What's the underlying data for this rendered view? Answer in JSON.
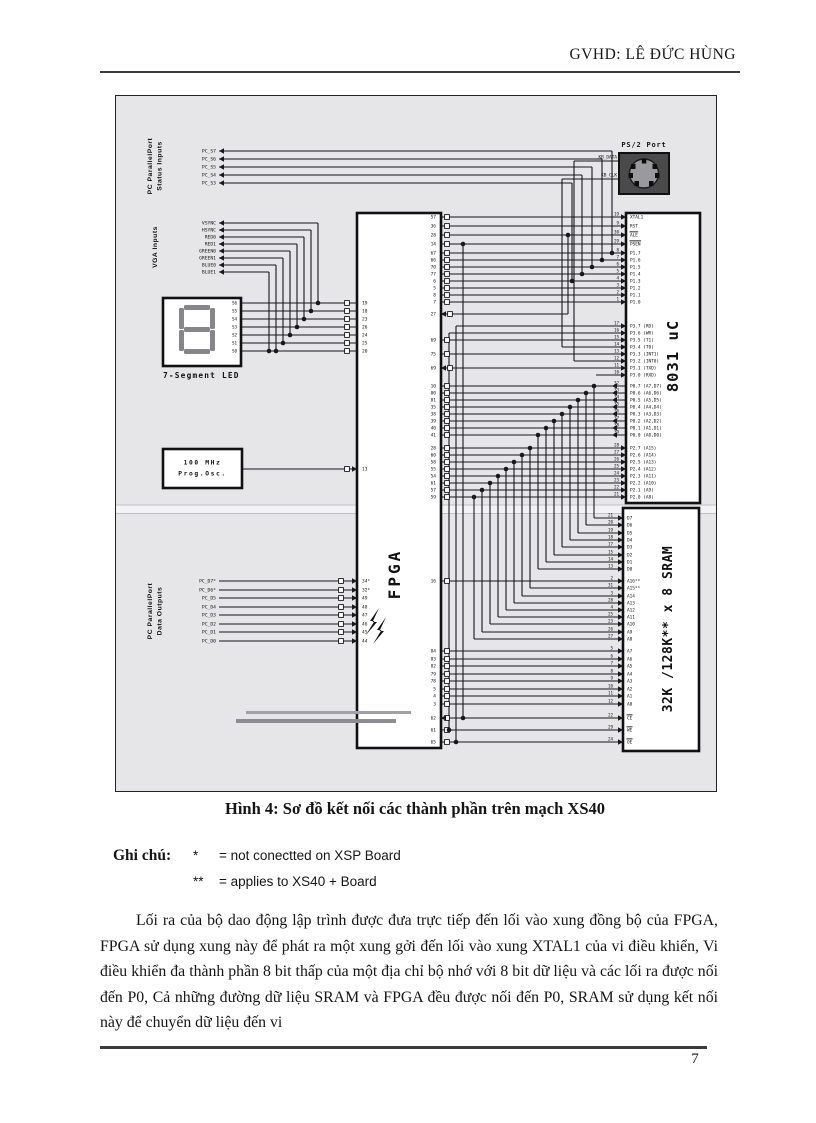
{
  "header": {
    "right": "GVHD: LÊ ĐỨC HÙNG"
  },
  "figure": {
    "caption": "Hình 4: Sơ đồ kết nối các thành phần trên mạch XS40",
    "pc_status": {
      "group_label_1": "PC ParallelPort",
      "group_label_2": "Status Inputs",
      "signals": [
        "PC_S7",
        "PC_S6",
        "PC_S5",
        "PC_S4",
        "PC_S3"
      ]
    },
    "vga": {
      "group_label": "VGA Inputs",
      "signals": [
        "VSYNC",
        "HSYNC",
        "RED0",
        "RED1",
        "GREEN0",
        "GREEN1",
        "BLUE0",
        "BLUE1"
      ]
    },
    "pc_data": {
      "group_label_1": "PC ParallelPort",
      "group_label_2": "Data Outputs",
      "signals": [
        "PC_D7*",
        "PC_D6*",
        "PC_D5",
        "PC_D4",
        "PC_D3",
        "PC_D2",
        "PC_D1",
        "PC_D0"
      ]
    },
    "seg_led": {
      "caption": "7-Segment LED",
      "pins": [
        "S6",
        "S5",
        "S4",
        "S3",
        "S2",
        "S1",
        "S0"
      ]
    },
    "osc": {
      "line1": "100 MHz",
      "line2": "Prog.Osc."
    },
    "ps2": {
      "title": "PS/2 Port",
      "signals": [
        "KB_DATA",
        "KB_CLK"
      ]
    },
    "fpga": {
      "label": "FPGA",
      "left_seg_pins": [
        "19",
        "18",
        "23",
        "26",
        "24",
        "25",
        "20"
      ],
      "osc_pin": "13",
      "left_data_pins": [
        "34*",
        "32*",
        "49",
        "48",
        "47",
        "46",
        "45",
        "44"
      ],
      "right_top_pins": [
        "57",
        "36",
        "28",
        "14",
        "67",
        "66",
        "70",
        "77",
        "6",
        "5",
        "8",
        "7"
      ],
      "right_single_pins": [
        "27",
        "69",
        "75",
        "69"
      ],
      "right_data_pins": [
        "10",
        "80",
        "81",
        "35",
        "38",
        "39",
        "40",
        "41"
      ],
      "a16_pin": "16",
      "right_addr_pins": [
        "28",
        "60",
        "58",
        "55",
        "54",
        "61",
        "57",
        "59"
      ],
      "right_addr_low_pins": [
        "84",
        "83",
        "82",
        "79",
        "78",
        "5",
        "4",
        "3"
      ],
      "right_ctrl_pins": [
        "62",
        "61",
        "65"
      ]
    },
    "mcu": {
      "label": "8031 uC",
      "top_pins": [
        {
          "num": "19",
          "name": "XTAL1"
        },
        {
          "num": "9",
          "name": "RST"
        },
        {
          "num": "30",
          "name": "ALE",
          "bar": true
        },
        {
          "num": "29",
          "name": "PSEN",
          "bar": true
        }
      ],
      "p1_pins": [
        {
          "num": "8",
          "name": "P1.7"
        },
        {
          "num": "7",
          "name": "P1.6"
        },
        {
          "num": "6",
          "name": "P1.5"
        },
        {
          "num": "5",
          "name": "P1.4"
        },
        {
          "num": "4",
          "name": "P1.3"
        },
        {
          "num": "3",
          "name": "P1.2"
        },
        {
          "num": "2",
          "name": "P1.1"
        },
        {
          "num": "1",
          "name": "P1.0"
        }
      ],
      "p3_pins": [
        {
          "num": "17",
          "name": "P3.7 (RD)"
        },
        {
          "num": "16",
          "name": "P3.6 (WR)"
        },
        {
          "num": "15",
          "name": "P3.5 (T1)"
        },
        {
          "num": "14",
          "name": "P3.4 (T0)"
        },
        {
          "num": "13",
          "name": "P3.3 (INT1)"
        },
        {
          "num": "12",
          "name": "P3.2 (INT0)"
        },
        {
          "num": "11",
          "name": "P3.1 (TXD)"
        },
        {
          "num": "10",
          "name": "P3.0 (RXD)"
        }
      ],
      "p0_pins": [
        {
          "num": "32",
          "name": "P0.7 (A7,D7)"
        },
        {
          "num": "33",
          "name": "P0.6 (A6,D6)"
        },
        {
          "num": "34",
          "name": "P0.5 (A5,D5)"
        },
        {
          "num": "35",
          "name": "P0.4 (A4,D4)"
        },
        {
          "num": "36",
          "name": "P0.3 (A3,D3)"
        },
        {
          "num": "37",
          "name": "P0.2 (A2,D2)"
        },
        {
          "num": "38",
          "name": "P0.1 (A1,D1)"
        },
        {
          "num": "39",
          "name": "P0.0 (A0,D0)"
        }
      ],
      "p2_pins": [
        {
          "num": "28",
          "name": "P2.7 (A15)"
        },
        {
          "num": "27",
          "name": "P2.6 (A14)"
        },
        {
          "num": "26",
          "name": "P2.5 (A13)"
        },
        {
          "num": "25",
          "name": "P2.4 (A12)"
        },
        {
          "num": "24",
          "name": "P2.3 (A11)"
        },
        {
          "num": "23",
          "name": "P2.2 (A10)"
        },
        {
          "num": "22",
          "name": "P2.1 (A9)"
        },
        {
          "num": "21",
          "name": "P2.0 (A8)"
        }
      ]
    },
    "sram": {
      "label": "32K /128K** x 8 SRAM",
      "d_pins": [
        {
          "num": "21",
          "name": "D7"
        },
        {
          "num": "20",
          "name": "D6"
        },
        {
          "num": "19",
          "name": "D5"
        },
        {
          "num": "18",
          "name": "D4"
        },
        {
          "num": "17",
          "name": "D3"
        },
        {
          "num": "15",
          "name": "D2"
        },
        {
          "num": "14",
          "name": "D1"
        },
        {
          "num": "13",
          "name": "D0"
        }
      ],
      "a16_pin": {
        "num": "2",
        "name": "A16**"
      },
      "a_hi_pins": [
        {
          "num": "31",
          "name": "A15**"
        },
        {
          "num": "3",
          "name": "A14"
        },
        {
          "num": "28",
          "name": "A13"
        },
        {
          "num": "4",
          "name": "A12"
        },
        {
          "num": "25",
          "name": "A11"
        },
        {
          "num": "23",
          "name": "A10"
        },
        {
          "num": "26",
          "name": "A9"
        },
        {
          "num": "27",
          "name": "A8"
        }
      ],
      "a_lo_pins": [
        {
          "num": "5",
          "name": "A7"
        },
        {
          "num": "6",
          "name": "A6"
        },
        {
          "num": "7",
          "name": "A5"
        },
        {
          "num": "8",
          "name": "A4"
        },
        {
          "num": "9",
          "name": "A3"
        },
        {
          "num": "10",
          "name": "A2"
        },
        {
          "num": "11",
          "name": "A1"
        },
        {
          "num": "12",
          "name": "A0"
        }
      ],
      "ctrl_pins": [
        {
          "num": "22",
          "name": "CE",
          "bar": true
        },
        {
          "num": "29",
          "name": "WE",
          "bar": true
        },
        {
          "num": "24",
          "name": "OE",
          "bar": true
        }
      ]
    },
    "colors": {
      "ink": "#17171c",
      "figure_bg": "#e6e6e8",
      "ps2_body": "#4a4a4a"
    }
  },
  "notes": {
    "label": "Ghi chú:",
    "items": [
      {
        "star": "*",
        "text": "= not conectted on XSP Board"
      },
      {
        "star": "**",
        "text": "= applies to XS40 + Board"
      }
    ]
  },
  "paragraph": "Lối ra của bộ dao động lập trình được đưa trực tiếp đến lối vào xung đồng bộ của FPGA, FPGA sử dụng xung này để phát ra một xung gởi đến lối vào xung XTAL1 của vi điều khiển, Vi điều khiển đa thành phần 8 bit thấp của một địa chỉ bộ nhớ với 8 bit dữ liệu và các lối ra được nối đến P0, Cả những đường dữ liệu SRAM và FPGA đều được nối đến P0, SRAM sử dụng kết nối này để chuyển dữ liệu đến vi",
  "page_number": "7"
}
